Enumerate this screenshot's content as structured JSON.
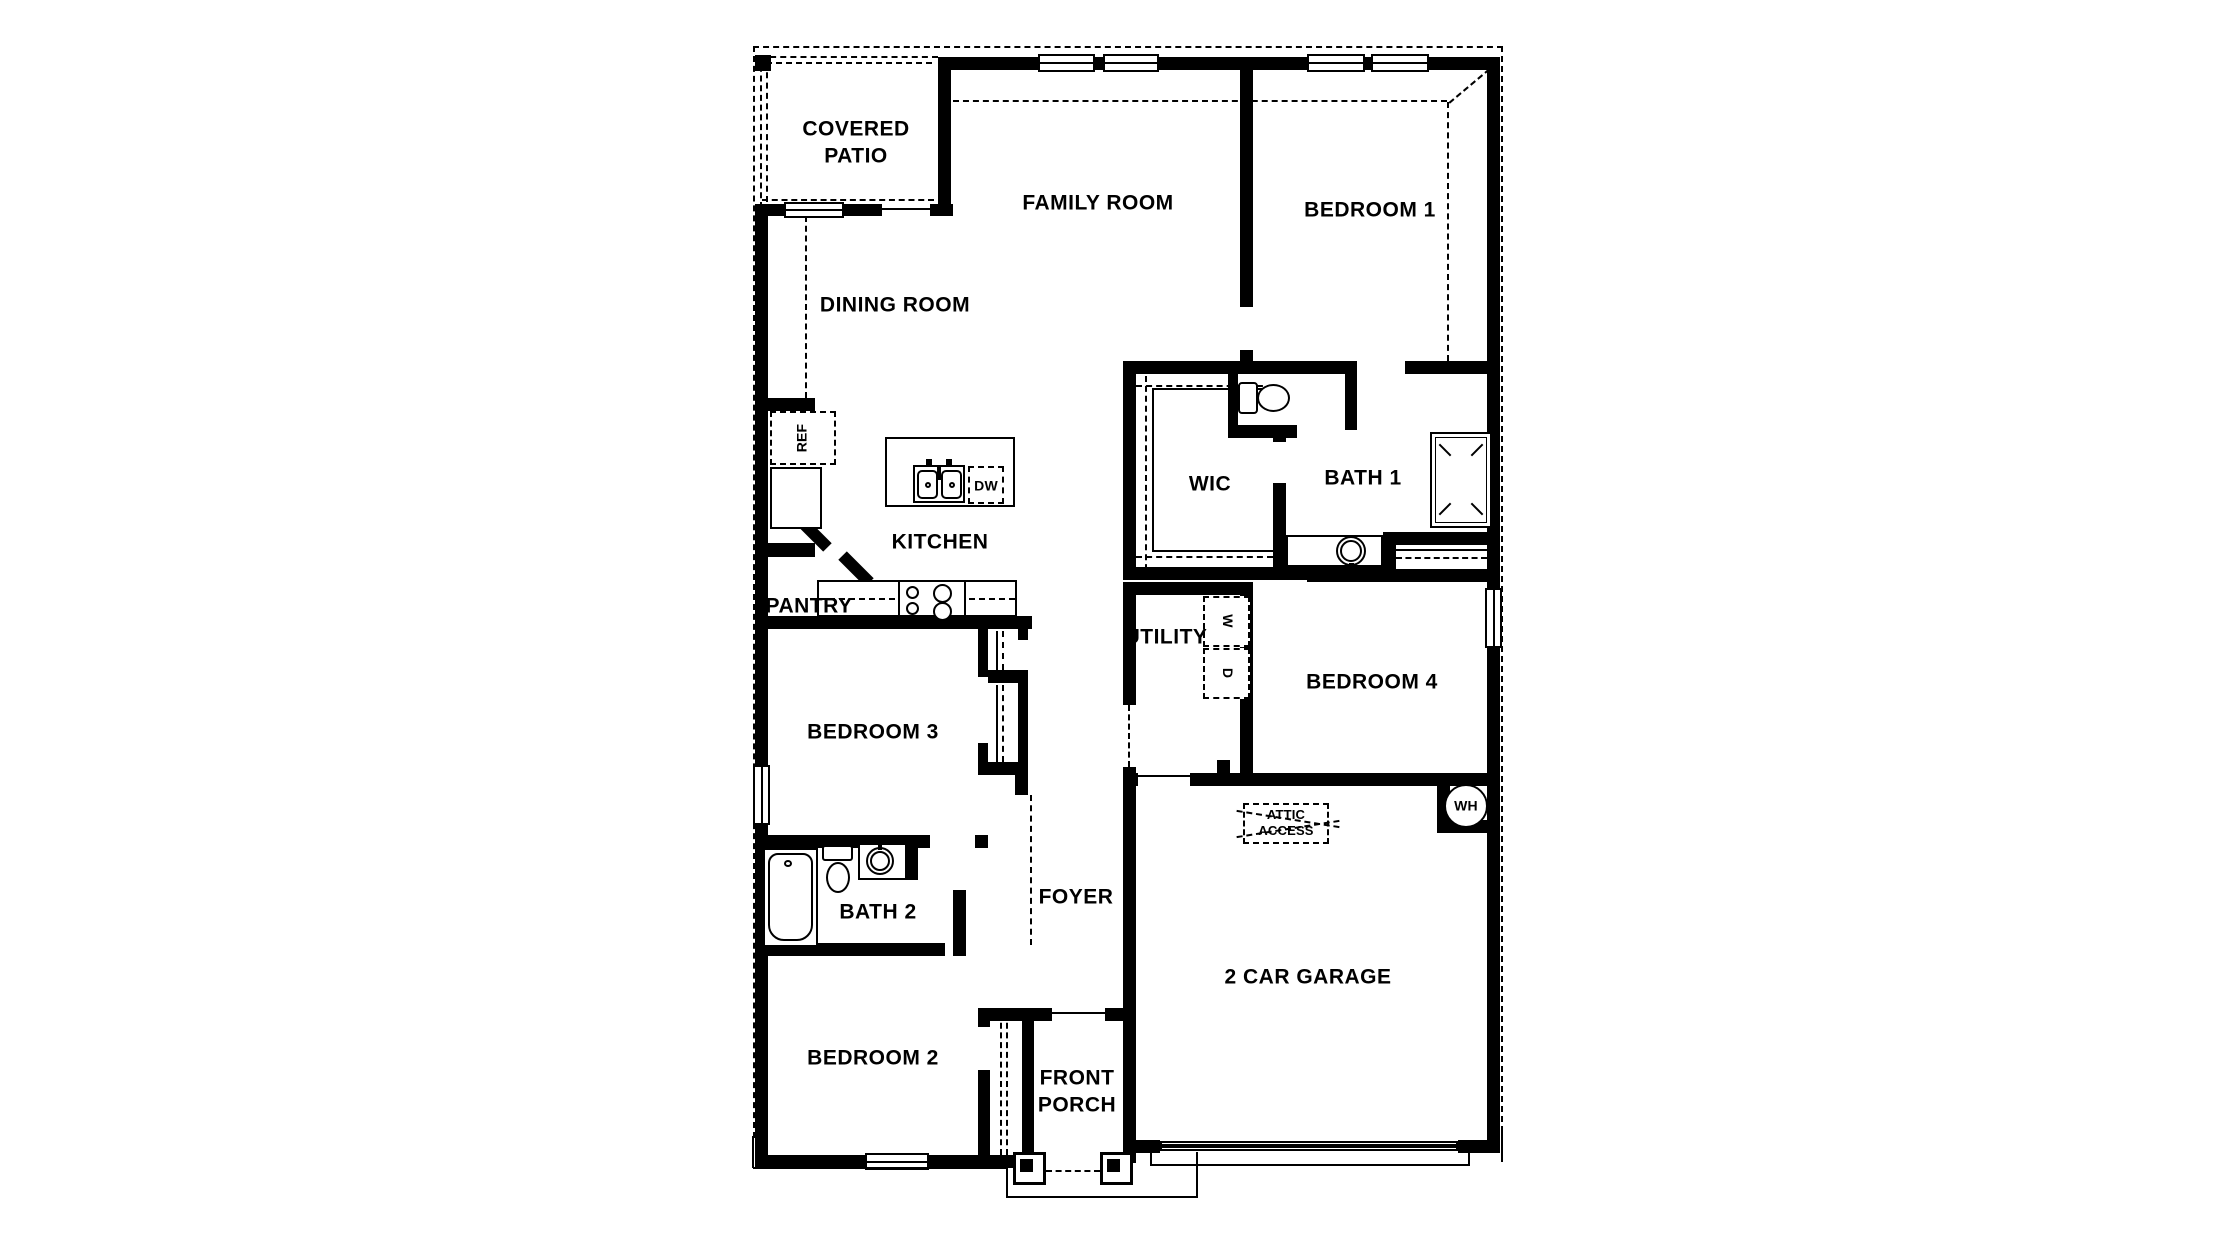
{
  "rooms": {
    "covered_patio": "COVERED\nPATIO",
    "family_room": "FAMILY ROOM",
    "bedroom_1": "BEDROOM 1",
    "dining_room": "DINING ROOM",
    "kitchen": "KITCHEN",
    "pantry": "PANTRY",
    "wic": "WIC",
    "bath_1": "BATH 1",
    "utility": "UTILITY",
    "bedroom_4": "BEDROOM 4",
    "bedroom_3": "BEDROOM 3",
    "bath_2": "BATH 2",
    "foyer": "FOYER",
    "bedroom_2": "BEDROOM 2",
    "garage": "2 CAR GARAGE",
    "front_porch": "FRONT\nPORCH"
  },
  "fixtures": {
    "refrigerator": "REF",
    "dishwasher": "DW",
    "washer": "W",
    "dryer": "D",
    "water_heater": "WH",
    "attic_access": "ATTIC\nACCESS"
  },
  "colors": {
    "ink": "#000000",
    "background": "#ffffff"
  }
}
